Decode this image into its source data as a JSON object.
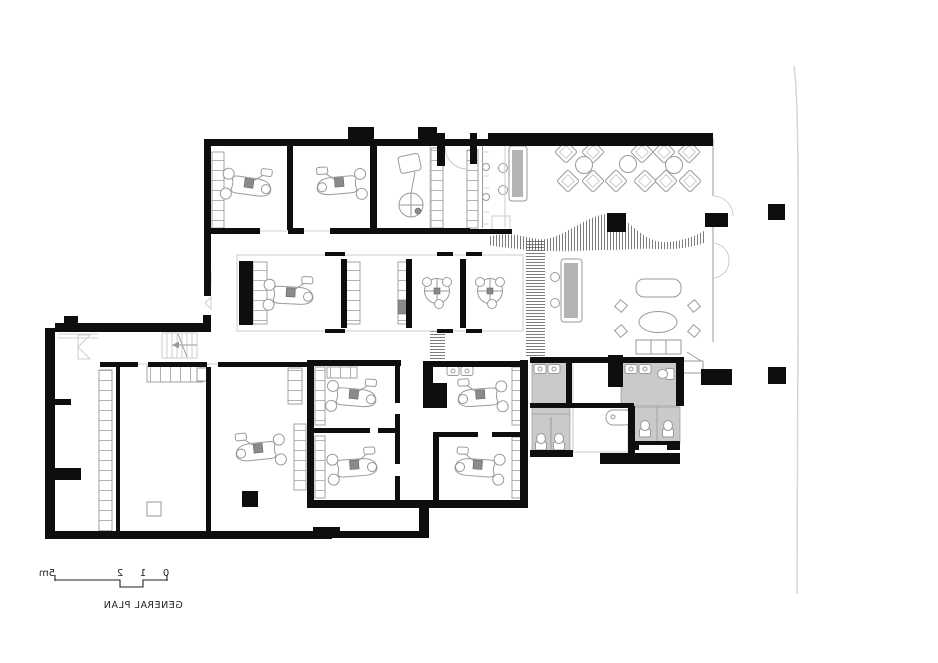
{
  "plan": {
    "title": "GENERAL PLAN",
    "text_mirrored": true,
    "scale_bar": {
      "labels": [
        "0",
        "1",
        "2",
        "5m"
      ]
    }
  },
  "palette": {
    "paper": "#ffffff",
    "wall": "#0e0e0e",
    "line": "#9a9a9a",
    "line_light": "#c2c2c2",
    "gray_room": "#cacaca",
    "desk_fill": "#b4b4b4",
    "unit_fill": "#8a8a8a",
    "hatch": "#5a5a5a",
    "fold": "#d5d5d5",
    "text": "#222222"
  },
  "symbols": {
    "dental_chair_count": 8,
    "round_treatment_unit_count": 2,
    "xray_unit_count": 1,
    "waiting_chair_count": 11,
    "round_table_count": 3,
    "reception_desk_count": 2,
    "sofa_count": 1,
    "oval_table_count": 1,
    "toilet_count": 5,
    "sink_count": 6,
    "bathtub_count": 1,
    "stairs_count": 1,
    "structural_column_count": 2
  }
}
